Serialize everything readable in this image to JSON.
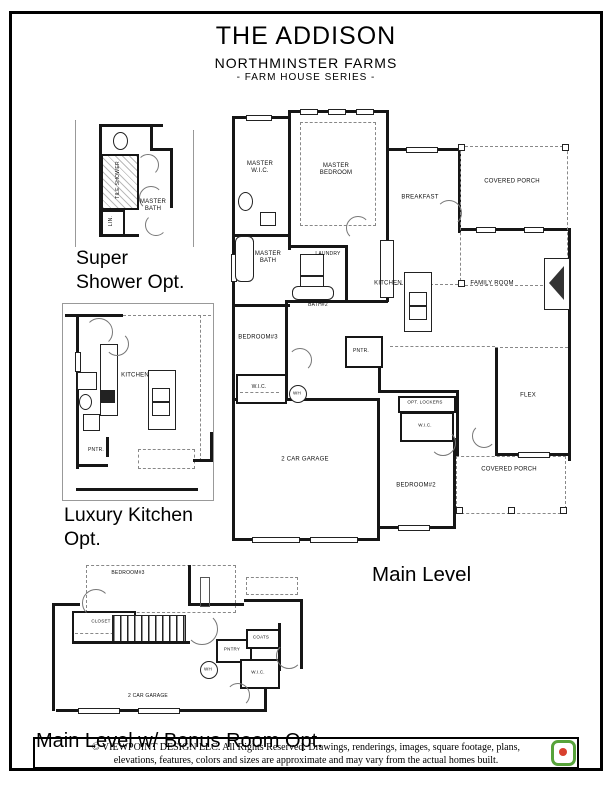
{
  "header": {
    "title": "THE ADDISON",
    "subtitle": "NORTHMINSTER FARMS",
    "series": "- FARM HOUSE SERIES -"
  },
  "plans": {
    "super_shower": {
      "caption_line1": "Super",
      "caption_line2": "Shower Opt.",
      "rooms": {
        "master_bath": "MASTER BATH",
        "tile_shower": "TILE SHOWER",
        "linen": "LIN."
      }
    },
    "luxury_kitchen": {
      "caption_line1": "Luxury Kitchen",
      "caption_line2": "Opt.",
      "rooms": {
        "kitchen": "KITCHEN",
        "pantry": "PNTR."
      }
    },
    "main_level": {
      "caption": "Main Level",
      "rooms": {
        "master_wic": "MASTER W.I.C.",
        "master_bedroom": "MASTER BEDROOM",
        "breakfast": "BREAKFAST",
        "covered_porch_top": "COVERED PORCH",
        "master_bath": "MASTER BATH",
        "laundry": "LAUNDRY",
        "bath2": "BATH#2",
        "kitchen": "KITCHEN",
        "family_room": "FAMILY ROOM",
        "bedroom3": "BEDROOM#3",
        "wic_bedroom3": "W.I.C.",
        "water_heater": "WH",
        "pantry": "PNTR.",
        "garage": "2 CAR GARAGE",
        "opt_lockers": "OPT. LOCKERS",
        "wic_bedroom2": "W.I.C.",
        "bedroom2": "BEDROOM#2",
        "flex": "FLEX",
        "covered_porch_bottom": "COVERED PORCH"
      }
    },
    "bonus": {
      "caption": "Main Level w/ Bonus Room Opt.",
      "rooms": {
        "bedroom3": "BEDROOM#3",
        "closet": "CLOSET",
        "garage": "2 CAR GARAGE",
        "pantry": "PNTRY",
        "coats": "COATS",
        "wic": "W.I.C.",
        "water_heater": "WH"
      }
    }
  },
  "footer": {
    "line1": "© VIEWPOINT DESIGN LLC. All Rights Reserved. Drawings, renderings, images, square footage, plans,",
    "line2": "elevations, features, colors and sizes are approximate and may vary from the actual homes built."
  },
  "colors": {
    "wall": "#161616",
    "dashed": "#888888",
    "logo_green": "#57a33a",
    "logo_red": "#d8402e"
  }
}
